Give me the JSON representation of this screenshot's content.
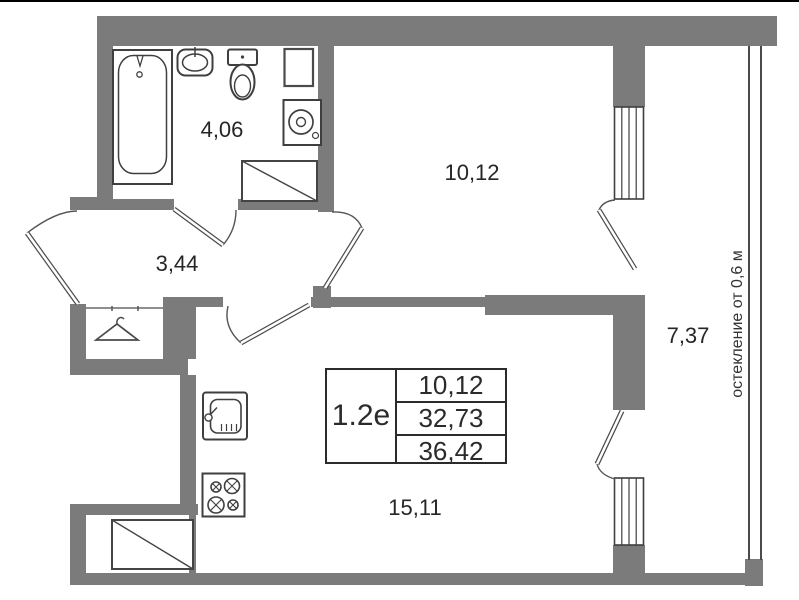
{
  "plan": {
    "info_table": {
      "type_label": "1.2е",
      "values": [
        "10,12",
        "32,73",
        "36,42"
      ]
    },
    "rooms": [
      {
        "name": "bathroom",
        "area_label": "4,06"
      },
      {
        "name": "hallway",
        "area_label": "3,44"
      },
      {
        "name": "bedroom",
        "area_label": "10,12"
      },
      {
        "name": "kitchen-living-room",
        "area_label": "15,11"
      },
      {
        "name": "balcony",
        "area_label": "7,37"
      }
    ],
    "balcony_note": "остекление от 0,6 м",
    "colors": {
      "wall": "#7b7b7b",
      "line": "#3f3f3f",
      "text": "#262626",
      "background": "#ffffff"
    },
    "icons": [
      "bathtub-icon",
      "bath-sink-icon",
      "toilet-icon",
      "washing-machine-icon",
      "wall-niche-icon",
      "shaft-hatch-icon",
      "hanger-icon",
      "kitchen-sink-icon",
      "stove-icon",
      "window-icon",
      "door-swing-icon",
      "glazing-line-icon"
    ]
  }
}
